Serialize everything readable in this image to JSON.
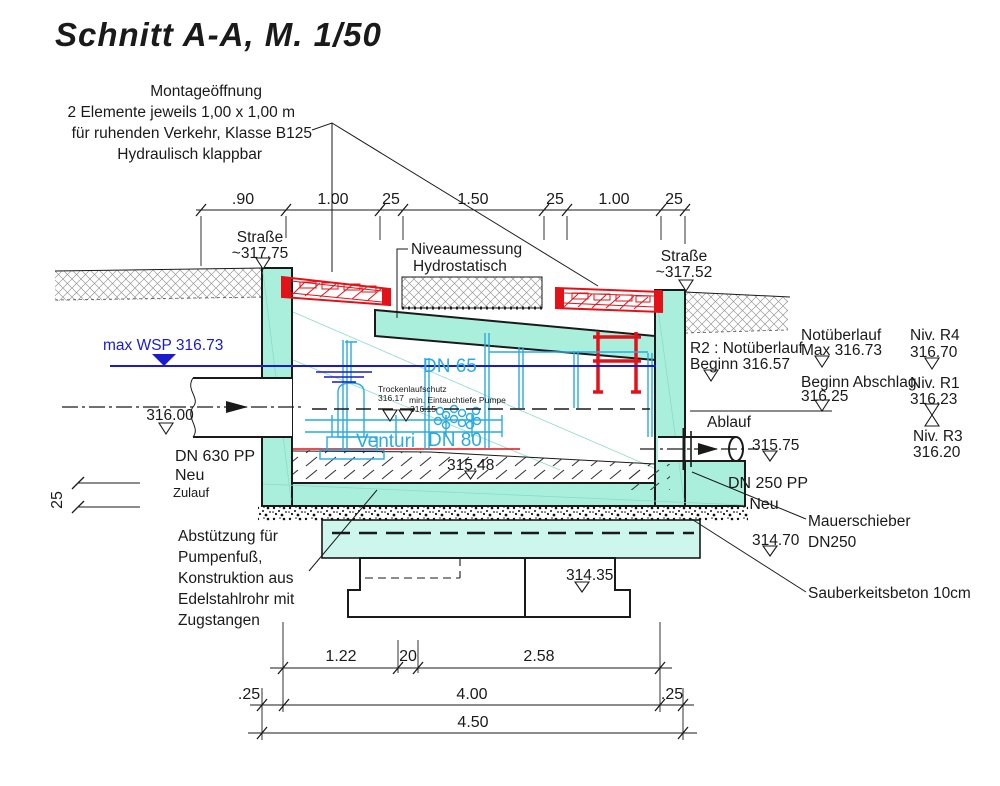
{
  "title": "Schnitt A-A, M. 1/50",
  "colors": {
    "concrete_teal": "#a9efdc",
    "concrete_teal_light": "#cdf6ec",
    "flap_red": "#e31219",
    "equipment_cyan": "#2aabdf",
    "water_blue": "#1a1ace",
    "line_black": "#1a1a1a",
    "soil_gray": "#9a9a9a"
  },
  "notes": {
    "montage": [
      "Montageöffnung",
      "2 Elemente jeweils 1,00 x 1,00 m",
      "für ruhenden Verkehr, Klasse B125",
      "Hydraulisch klappbar"
    ],
    "niveau": [
      "Niveaumessung",
      "Hydrostatisch"
    ],
    "strasse_links": [
      "Straße",
      "~317.75"
    ],
    "strasse_rechts": [
      "Straße",
      "~317.52"
    ],
    "max_wsp": "max WSP 316.73",
    "zulauf_level": "316.00",
    "zulauf": [
      "DN 630 PP",
      "Neu",
      "Zulauf"
    ],
    "abstuetzung": [
      "Abstützung für",
      "Pumpenfuß,",
      "Konstruktion aus",
      "Edelstahlrohr mit",
      "Zugstangen"
    ],
    "trocken": [
      "Trockenlaufschutz",
      "316.17"
    ],
    "eintauch": [
      "min. Eintauchtiefe Pumpe",
      "316.15"
    ],
    "dn65": "DN 65",
    "venturi": "Venturi",
    "dn80": "DN 80",
    "sohle": "315.48",
    "r2": [
      "R2 : Notüberlauf",
      "Beginn 316.57"
    ],
    "ablauf": "Ablauf",
    "ablauf_level": "315.75",
    "dn250": [
      "DN 250 PP",
      "Neu"
    ],
    "notueberlauf": [
      "Notüberlauf",
      "Max 316.73"
    ],
    "abschlag": [
      "Beginn Abschlag",
      "316.25"
    ],
    "niv_r4": [
      "Niv. R4",
      "316.70"
    ],
    "niv_r1": [
      "Niv. R1",
      "316.23"
    ],
    "niv_r3": [
      "Niv. R3",
      "316.20"
    ],
    "mauerschieber": [
      "Mauerschieber",
      "DN250"
    ],
    "sauberkeit": "Sauberkeitsbeton 10cm",
    "level_31470": "314.70",
    "level_31435": "314.35",
    "wand25": "25"
  },
  "dims": {
    "top": [
      ".90",
      "1.00",
      "25",
      "1.50",
      "25",
      "1.00",
      "25"
    ],
    "b1": [
      "1.22",
      "20",
      "2.58"
    ],
    "b2": [
      ".25",
      "4.00",
      ".25"
    ],
    "b3": "4.50"
  }
}
